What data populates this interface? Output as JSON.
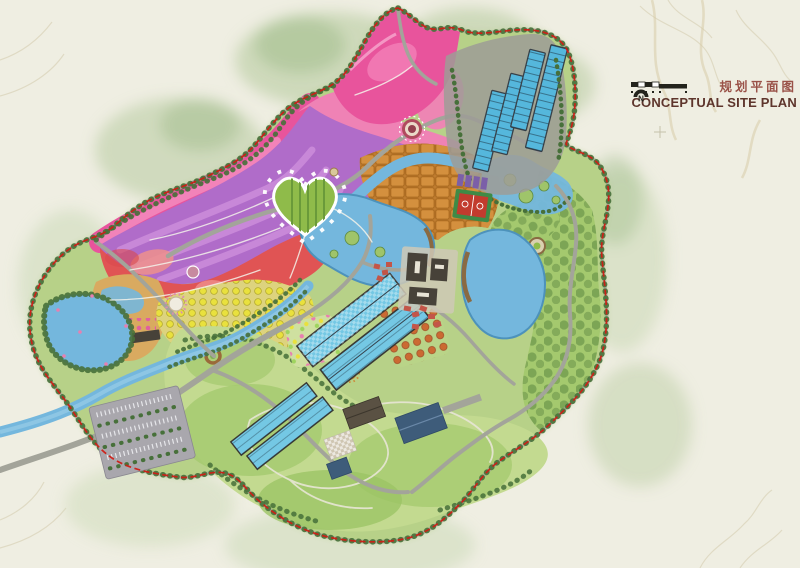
{
  "title": {
    "zh": "规划平面图",
    "en": "CONCEPTUAL SITE PLAN"
  },
  "compass": {
    "label": "N"
  },
  "palette": {
    "paper": "#efeee2",
    "contour": "#ddd7bf",
    "context": "#b7cba0",
    "context_soft": "#cfdcbc",
    "site_base": "#b7d188",
    "hill_light": "#c3da90",
    "hill_mid": "#a4c96e",
    "hill_dark": "#6f9c49",
    "tree_dark": "#47703a",
    "purple": "#b06cc9",
    "purple_light": "#d092dd",
    "magenta": "#e8549c",
    "pink": "#ef82b5",
    "red": "#e05454",
    "salmon": "#ef908c",
    "yellow_ground": "#ddd37e",
    "yellow_dot": "#e9e13d",
    "orange": "#d6923f",
    "orange_cell": "#bf7c30",
    "tan": "#d9aa60",
    "water": "#74b7dd",
    "water_deep": "#4d92bb",
    "gh_blue": "#55b7dc",
    "gh_cyan": "#74c8e4",
    "gh_frame": "#39424a",
    "pad_gray": "#9d9c96",
    "road": "#a3a49a",
    "path_white": "#f4f3ea",
    "roof_dark": "#474239",
    "roof_brown": "#5a5143",
    "roof_blue": "#3e5c7a",
    "roof_red": "#c35548",
    "court_red": "#c23b2e",
    "court_green": "#3f8a46",
    "pergola_purple": "#7b5fa8",
    "boundary_red": "#cf1d15",
    "parking_gray": "#a9a7ad",
    "title_zh": "#9a5248",
    "title_en": "#5e352c",
    "compass_dark": "#23231c"
  },
  "map": {
    "features": {
      "context": "context-terrain",
      "site": "site-area",
      "purple": "purple-flower-fields",
      "magenta": "magenta-flower-band",
      "pink": "pink-flower-fields",
      "red": "red-flower-fields",
      "heart": "heart-garden",
      "orchard": "yellow-orchard",
      "terrace": "terraced-orange-fields",
      "compound": "garden-compound",
      "hills_s": "south-hills",
      "hills_e": "east-hills",
      "river": "river",
      "lake_c": "central-lake",
      "lake_e": "east-lake",
      "pond_w": "west-pond",
      "wetland": "wetland-garden",
      "gh_n": "north-greenhouses",
      "gh_c": "central-greenhouses",
      "gh_s": "south-greenhouses",
      "visitor": "visitor-center-complex",
      "court": "sports-court",
      "farm": "farmstead-buildings",
      "parking": "parking-lot",
      "roads": "ring-roads",
      "boundary": "site-boundary"
    }
  }
}
